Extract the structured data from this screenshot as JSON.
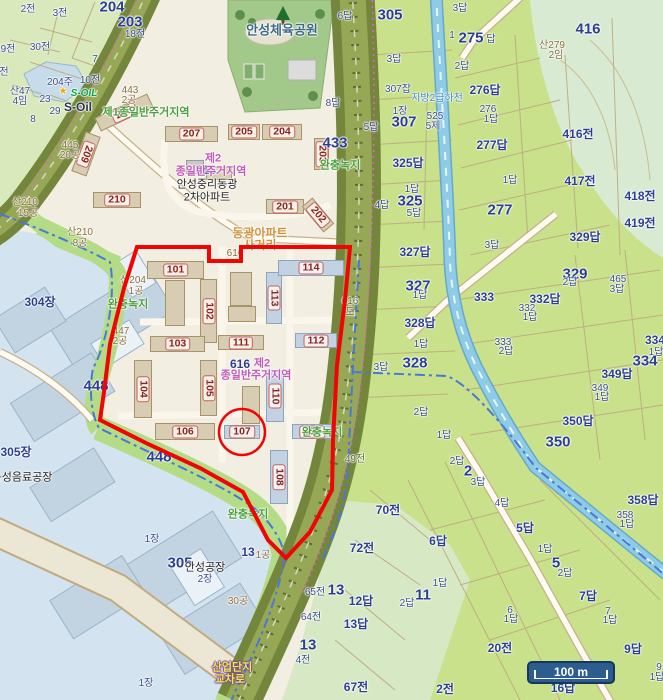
{
  "map": {
    "colors": {
      "boundary_red": "#f00404",
      "admin_dash_blue": "#4878d8",
      "paddy_green": "#c8e18a",
      "field_green": "#d9e9bb",
      "urban_cream": "#f2eee1",
      "industrial_blue": "#d3e3ef",
      "road_band_olive": "#74863c",
      "stream_blue": "#8ecbe6",
      "park_green": "#a3c98a"
    },
    "scale_bar": {
      "label": "100 m"
    },
    "highlight": {
      "circled_building": "107"
    },
    "labels": [
      {
        "t": "204",
        "c": "big",
        "x": 112,
        "y": 7
      },
      {
        "t": "2전",
        "c": "sm",
        "x": 28,
        "y": 10
      },
      {
        "t": "3전",
        "c": "sm",
        "x": 60,
        "y": 14
      },
      {
        "t": "203",
        "c": "big",
        "x": 130,
        "y": 22
      },
      {
        "t": "18전",
        "c": "sm",
        "x": 135,
        "y": 35
      },
      {
        "t": "30전",
        "c": "sm",
        "x": 40,
        "y": 48
      },
      {
        "t": "9전",
        "c": "sm",
        "x": 8,
        "y": 50
      },
      {
        "t": "7",
        "c": "sm",
        "x": 95,
        "y": 60
      },
      {
        "t": "전",
        "c": "sm",
        "x": 4,
        "y": 73
      },
      {
        "t": "204주",
        "c": "sm",
        "x": 60,
        "y": 83
      },
      {
        "t": "10전",
        "c": "sm",
        "x": 90,
        "y": 81
      },
      {
        "t": "산47",
        "c": "sm",
        "x": 20,
        "y": 92
      },
      {
        "t": "4임",
        "c": "sm",
        "x": 20,
        "y": 102
      },
      {
        "t": "23",
        "c": "sm",
        "x": 45,
        "y": 100
      },
      {
        "t": "29",
        "c": "sm",
        "x": 55,
        "y": 112
      },
      {
        "t": "8",
        "c": "sm",
        "x": 33,
        "y": 120
      },
      {
        "t": "★",
        "c": "star",
        "x": 63,
        "y": 92,
        "n": "soil-star-icon"
      },
      {
        "t": "S-OIL",
        "c": "soil",
        "x": 84,
        "y": 94,
        "n": "soil-logo"
      },
      {
        "t": "S-Oil",
        "c": "soildark",
        "x": 78,
        "y": 107
      },
      {
        "t": "443",
        "c": "brown",
        "x": 130,
        "y": 91
      },
      {
        "t": "2공",
        "c": "brown",
        "x": 129,
        "y": 101
      },
      {
        "t": "제1종일반주거지역",
        "c": "green",
        "x": 146,
        "y": 113
      },
      {
        "t": "445",
        "c": "brown",
        "x": 70,
        "y": 146
      },
      {
        "t": "20공",
        "c": "brown",
        "x": 70,
        "y": 156
      },
      {
        "t": "안성체육공원",
        "c": "park",
        "x": 282,
        "y": 30
      },
      {
        "t": "안성중리동광",
        "c": "black",
        "x": 207,
        "y": 185
      },
      {
        "t": "2차아파트",
        "c": "black",
        "x": 207,
        "y": 198
      },
      {
        "t": "제2",
        "c": "purple",
        "x": 213,
        "y": 159
      },
      {
        "t": "616",
        "c": "med",
        "x": 206,
        "y": 170
      },
      {
        "t": "종일반주거지역",
        "c": "purple",
        "x": 211,
        "y": 172
      },
      {
        "t": "433",
        "c": "big",
        "x": 335,
        "y": 143
      },
      {
        "t": "완충녹지",
        "c": "green",
        "x": 340,
        "y": 166
      },
      {
        "t": "8답",
        "c": "sm",
        "x": 333,
        "y": 104
      },
      {
        "t": "5답",
        "c": "sm",
        "x": 371,
        "y": 128
      },
      {
        "t": "6답",
        "c": "sm",
        "x": 345,
        "y": 17
      },
      {
        "t": "305",
        "c": "big",
        "x": 390,
        "y": 15
      },
      {
        "t": "3답",
        "c": "sm",
        "x": 460,
        "y": 9
      },
      {
        "t": "1",
        "c": "sm",
        "x": 452,
        "y": 36
      },
      {
        "t": "275",
        "c": "big",
        "x": 471,
        "y": 38
      },
      {
        "t": "답",
        "c": "sm",
        "x": 491,
        "y": 40
      },
      {
        "t": "416",
        "c": "big",
        "x": 588,
        "y": 29
      },
      {
        "t": "산279",
        "c": "brown",
        "x": 552,
        "y": 46
      },
      {
        "t": "2임",
        "c": "brown",
        "x": 556,
        "y": 56
      },
      {
        "t": "3답",
        "c": "sm",
        "x": 394,
        "y": 60
      },
      {
        "t": "2답",
        "c": "sm",
        "x": 462,
        "y": 67
      },
      {
        "t": "276답",
        "c": "med",
        "x": 485,
        "y": 90
      },
      {
        "t": "307잡",
        "c": "sm",
        "x": 398,
        "y": 90
      },
      {
        "t": "지방2급하천",
        "c": "water",
        "x": 437,
        "y": 99
      },
      {
        "t": "1장",
        "c": "sm",
        "x": 400,
        "y": 112
      },
      {
        "t": "307",
        "c": "big",
        "x": 404,
        "y": 122
      },
      {
        "t": "525",
        "c": "sm",
        "x": 435,
        "y": 117
      },
      {
        "t": "5제",
        "c": "sm",
        "x": 433,
        "y": 127
      },
      {
        "t": "276",
        "c": "sm",
        "x": 488,
        "y": 110
      },
      {
        "t": "1답",
        "c": "sm",
        "x": 491,
        "y": 120
      },
      {
        "t": "416전",
        "c": "med",
        "x": 578,
        "y": 134
      },
      {
        "t": "277답",
        "c": "med",
        "x": 492,
        "y": 145
      },
      {
        "t": "325답",
        "c": "med",
        "x": 408,
        "y": 163
      },
      {
        "t": "1답",
        "c": "sm",
        "x": 412,
        "y": 190
      },
      {
        "t": "325",
        "c": "big",
        "x": 410,
        "y": 201
      },
      {
        "t": "4답",
        "c": "sm",
        "x": 382,
        "y": 206
      },
      {
        "t": "5답",
        "c": "sm",
        "x": 414,
        "y": 214
      },
      {
        "t": "1답",
        "c": "sm",
        "x": 510,
        "y": 181
      },
      {
        "t": "417전",
        "c": "med",
        "x": 580,
        "y": 181
      },
      {
        "t": "418전",
        "c": "med",
        "x": 640,
        "y": 196
      },
      {
        "t": "277",
        "c": "big",
        "x": 500,
        "y": 210
      },
      {
        "t": "419전",
        "c": "med",
        "x": 640,
        "y": 223
      },
      {
        "t": "329답",
        "c": "med",
        "x": 585,
        "y": 237
      },
      {
        "t": "327답",
        "c": "med",
        "x": 415,
        "y": 252
      },
      {
        "t": "3답",
        "c": "sm",
        "x": 492,
        "y": 246
      },
      {
        "t": "329",
        "c": "big",
        "x": 575,
        "y": 274
      },
      {
        "t": "2답",
        "c": "sm",
        "x": 570,
        "y": 283
      },
      {
        "t": "465",
        "c": "sm",
        "x": 618,
        "y": 280
      },
      {
        "t": "3답",
        "c": "sm",
        "x": 617,
        "y": 290
      },
      {
        "t": "327",
        "c": "big",
        "x": 418,
        "y": 286
      },
      {
        "t": "1답",
        "c": "sm",
        "x": 420,
        "y": 296
      },
      {
        "t": "333",
        "c": "med",
        "x": 484,
        "y": 297
      },
      {
        "t": "332답",
        "c": "med",
        "x": 545,
        "y": 299
      },
      {
        "t": "332",
        "c": "sm",
        "x": 527,
        "y": 309
      },
      {
        "t": "1답",
        "c": "sm",
        "x": 530,
        "y": 318
      },
      {
        "t": "328답",
        "c": "med",
        "x": 420,
        "y": 323
      },
      {
        "t": "1답",
        "c": "sm",
        "x": 421,
        "y": 345
      },
      {
        "t": "333",
        "c": "sm",
        "x": 503,
        "y": 343
      },
      {
        "t": "2답",
        "c": "sm",
        "x": 506,
        "y": 352
      },
      {
        "t": "334",
        "c": "med",
        "x": 655,
        "y": 340
      },
      {
        "t": "1답",
        "c": "sm",
        "x": 656,
        "y": 353
      },
      {
        "t": "334",
        "c": "big",
        "x": 645,
        "y": 361
      },
      {
        "t": "328",
        "c": "big",
        "x": 415,
        "y": 363
      },
      {
        "t": "3답",
        "c": "sm",
        "x": 381,
        "y": 368
      },
      {
        "t": "349답",
        "c": "med",
        "x": 617,
        "y": 374
      },
      {
        "t": "349",
        "c": "sm",
        "x": 600,
        "y": 389
      },
      {
        "t": "1답",
        "c": "sm",
        "x": 602,
        "y": 398
      },
      {
        "t": "2답",
        "c": "sm",
        "x": 421,
        "y": 413
      },
      {
        "t": "350답",
        "c": "med",
        "x": 578,
        "y": 421
      },
      {
        "t": "1답",
        "c": "sm",
        "x": 444,
        "y": 436
      },
      {
        "t": "350",
        "c": "big",
        "x": 558,
        "y": 442
      },
      {
        "t": "2답",
        "c": "sm",
        "x": 457,
        "y": 462
      },
      {
        "t": "2",
        "c": "big",
        "x": 468,
        "y": 471
      },
      {
        "t": "3답",
        "c": "sm",
        "x": 478,
        "y": 483
      },
      {
        "t": "4답",
        "c": "sm",
        "x": 502,
        "y": 504
      },
      {
        "t": "70전",
        "c": "med",
        "x": 388,
        "y": 510
      },
      {
        "t": "5답",
        "c": "med",
        "x": 525,
        "y": 528
      },
      {
        "t": "358답",
        "c": "med",
        "x": 643,
        "y": 500
      },
      {
        "t": "358",
        "c": "sm",
        "x": 625,
        "y": 516
      },
      {
        "t": "1답",
        "c": "sm",
        "x": 627,
        "y": 525
      },
      {
        "t": "72전",
        "c": "med",
        "x": 362,
        "y": 548
      },
      {
        "t": "6답",
        "c": "med",
        "x": 438,
        "y": 541
      },
      {
        "t": "1답",
        "c": "sm",
        "x": 545,
        "y": 550
      },
      {
        "t": "5",
        "c": "big",
        "x": 556,
        "y": 563
      },
      {
        "t": "2답",
        "c": "sm",
        "x": 565,
        "y": 574
      },
      {
        "t": "12답",
        "c": "med",
        "x": 361,
        "y": 601
      },
      {
        "t": "11",
        "c": "big",
        "x": 423,
        "y": 595
      },
      {
        "t": "2답",
        "c": "sm",
        "x": 407,
        "y": 604
      },
      {
        "t": "1답",
        "c": "sm",
        "x": 440,
        "y": 584
      },
      {
        "t": "13답",
        "c": "med",
        "x": 356,
        "y": 624
      },
      {
        "t": "7답",
        "c": "med",
        "x": 588,
        "y": 596
      },
      {
        "t": "7",
        "c": "sm",
        "x": 608,
        "y": 612
      },
      {
        "t": "1답",
        "c": "sm",
        "x": 610,
        "y": 621
      },
      {
        "t": "6",
        "c": "sm",
        "x": 510,
        "y": 611
      },
      {
        "t": "1답",
        "c": "sm",
        "x": 511,
        "y": 620
      },
      {
        "t": "20전",
        "c": "med",
        "x": 500,
        "y": 648
      },
      {
        "t": "9답",
        "c": "med",
        "x": 633,
        "y": 649
      },
      {
        "t": "67전",
        "c": "med",
        "x": 356,
        "y": 687
      },
      {
        "t": "2전",
        "c": "med",
        "x": 445,
        "y": 689
      },
      {
        "t": "16답",
        "c": "med",
        "x": 563,
        "y": 688
      },
      {
        "t": "9",
        "c": "sm",
        "x": 659,
        "y": 668
      },
      {
        "t": "1답",
        "c": "sm",
        "x": 657,
        "y": 678
      },
      {
        "t": "65전",
        "c": "sm",
        "x": 315,
        "y": 593
      },
      {
        "t": "13",
        "c": "big",
        "x": 336,
        "y": 590
      },
      {
        "t": "64전",
        "c": "sm",
        "x": 311,
        "y": 618
      },
      {
        "t": "13",
        "c": "big",
        "x": 308,
        "y": 645
      },
      {
        "t": "4전",
        "c": "sm",
        "x": 303,
        "y": 661
      },
      {
        "t": "304장",
        "c": "med",
        "x": 40,
        "y": 302
      },
      {
        "t": "305장",
        "c": "med",
        "x": 16,
        "y": 452
      },
      {
        "t": "동성음료공장",
        "c": "black",
        "x": 22,
        "y": 478
      },
      {
        "t": "1장",
        "c": "sm",
        "x": 152,
        "y": 540
      },
      {
        "t": "305",
        "c": "big",
        "x": 180,
        "y": 563
      },
      {
        "t": "안성공장",
        "c": "black",
        "x": 205,
        "y": 568
      },
      {
        "t": "2장",
        "c": "sm",
        "x": 205,
        "y": 580
      },
      {
        "t": "1장",
        "c": "sm",
        "x": 146,
        "y": 684
      },
      {
        "t": "13",
        "c": "med",
        "x": 248,
        "y": 552
      },
      {
        "t": "1공",
        "c": "brown",
        "x": 263,
        "y": 556
      },
      {
        "t": "30공",
        "c": "brown",
        "x": 238,
        "y": 602
      },
      {
        "t": "산업단지",
        "c": "yellow",
        "x": 232,
        "y": 668
      },
      {
        "t": "교차로",
        "c": "yellow",
        "x": 230,
        "y": 680
      },
      {
        "t": "완충녹지",
        "c": "green",
        "x": 128,
        "y": 305
      },
      {
        "t": "완충녹지",
        "c": "green",
        "x": 248,
        "y": 515
      },
      {
        "t": "완충녹지",
        "c": "green",
        "x": 322,
        "y": 433
      },
      {
        "t": "산210",
        "c": "brown",
        "x": 25,
        "y": 203
      },
      {
        "t": "15공",
        "c": "brown",
        "x": 28,
        "y": 214
      },
      {
        "t": "산210",
        "c": "brown",
        "x": 80,
        "y": 233
      },
      {
        "t": "8공",
        "c": "brown",
        "x": 80,
        "y": 244
      },
      {
        "t": "산204",
        "c": "brown",
        "x": 133,
        "y": 281
      },
      {
        "t": "1공",
        "c": "brown",
        "x": 136,
        "y": 292
      },
      {
        "t": "447",
        "c": "brown",
        "x": 121,
        "y": 332
      },
      {
        "t": "2공",
        "c": "brown",
        "x": 120,
        "y": 342
      },
      {
        "t": "448",
        "c": "big",
        "x": 96,
        "y": 386
      },
      {
        "t": "448",
        "c": "big",
        "x": 159,
        "y": 457
      },
      {
        "t": "동광아파트",
        "c": "road",
        "x": 260,
        "y": 233
      },
      {
        "t": "사거리",
        "c": "road",
        "x": 260,
        "y": 245
      },
      {
        "t": "616",
        "c": "brown",
        "x": 235,
        "y": 254
      },
      {
        "t": "616",
        "c": "med",
        "x": 240,
        "y": 364
      },
      {
        "t": "제2",
        "c": "purple",
        "x": 262,
        "y": 364
      },
      {
        "t": "종일반주거지역",
        "c": "purple",
        "x": 256,
        "y": 376
      },
      {
        "t": "616",
        "c": "olive",
        "x": 350,
        "y": 302
      },
      {
        "t": "도",
        "c": "olive",
        "x": 350,
        "y": 313
      },
      {
        "t": "49전",
        "c": "olive",
        "x": 355,
        "y": 460
      }
    ],
    "buildings": [
      {
        "label": "208",
        "x": 95,
        "y": 105,
        "w": 58,
        "h": 15,
        "r": -25
      },
      {
        "label": "209",
        "x": 78,
        "y": 133,
        "w": 16,
        "h": 42,
        "r": 20,
        "lr": 90
      },
      {
        "label": "210",
        "x": 93,
        "y": 192,
        "w": 48,
        "h": 16
      },
      {
        "label": "207",
        "x": 165,
        "y": 126,
        "w": 53,
        "h": 16
      },
      {
        "label": "205",
        "x": 228,
        "y": 124,
        "w": 32,
        "h": 16
      },
      {
        "label": "204",
        "x": 262,
        "y": 124,
        "w": 40,
        "h": 16
      },
      {
        "label": "203",
        "x": 314,
        "y": 138,
        "w": 15,
        "h": 32,
        "lr": 90
      },
      {
        "label": "201",
        "x": 266,
        "y": 199,
        "w": 38,
        "h": 15
      },
      {
        "label": "202",
        "x": 311,
        "y": 198,
        "w": 14,
        "h": 34,
        "r": -40,
        "lr": 90
      },
      {
        "label": "",
        "x": 186,
        "y": 160,
        "w": 18,
        "h": 14,
        "gray": true
      },
      {
        "label": "",
        "x": 206,
        "y": 167,
        "w": 26,
        "h": 13
      },
      {
        "label": "101",
        "x": 147,
        "y": 261,
        "w": 57,
        "h": 18
      },
      {
        "label": "",
        "x": 165,
        "y": 280,
        "w": 20,
        "h": 46
      },
      {
        "label": "102",
        "x": 200,
        "y": 279,
        "w": 17,
        "h": 64,
        "lr": 90
      },
      {
        "label": "103",
        "x": 150,
        "y": 336,
        "w": 55,
        "h": 16
      },
      {
        "label": "104",
        "x": 134,
        "y": 360,
        "w": 18,
        "h": 58,
        "lr": 90
      },
      {
        "label": "105",
        "x": 200,
        "y": 360,
        "w": 17,
        "h": 56,
        "lr": 90
      },
      {
        "label": "106",
        "x": 155,
        "y": 423,
        "w": 60,
        "h": 17
      },
      {
        "label": "107",
        "x": 224,
        "y": 425,
        "w": 36,
        "h": 14,
        "blue": true
      },
      {
        "label": "108",
        "x": 270,
        "y": 450,
        "w": 18,
        "h": 54,
        "blue": true,
        "lr": 90
      },
      {
        "label": "109",
        "x": 292,
        "y": 424,
        "w": 40,
        "h": 15,
        "blue": true
      },
      {
        "label": "110",
        "x": 266,
        "y": 370,
        "w": 18,
        "h": 52,
        "blue": true,
        "lr": 90
      },
      {
        "label": "111",
        "x": 218,
        "y": 335,
        "w": 46,
        "h": 15
      },
      {
        "label": "112",
        "x": 295,
        "y": 333,
        "w": 42,
        "h": 15,
        "blue": true
      },
      {
        "label": "113",
        "x": 266,
        "y": 272,
        "w": 16,
        "h": 52,
        "blue": true,
        "lr": 90
      },
      {
        "label": "114",
        "x": 278,
        "y": 260,
        "w": 66,
        "h": 16,
        "blue": true
      },
      {
        "label": "",
        "x": 230,
        "y": 272,
        "w": 22,
        "h": 34
      },
      {
        "label": "",
        "x": 228,
        "y": 306,
        "w": 28,
        "h": 16
      },
      {
        "label": "",
        "x": 242,
        "y": 386,
        "w": 18,
        "h": 38
      }
    ]
  }
}
